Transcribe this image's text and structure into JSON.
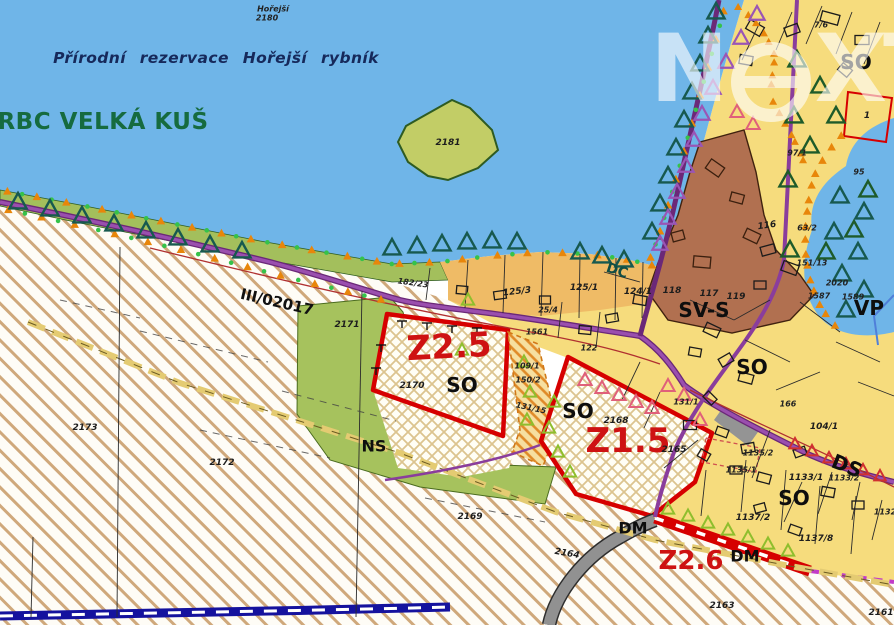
{
  "watermark": {
    "n": "N",
    "e": "e",
    "x": "X",
    "t": "T"
  },
  "colors": {
    "water": "#6FB5E8",
    "parcel_yellow": "#F6DC7D",
    "orange_band": "#EFBB66",
    "brown_zone": "#B17050",
    "green_area": "#A6C25D",
    "island_green": "#C2CD66",
    "zone_red": "#D60000",
    "road_purple": "#8A3D9C",
    "trail_khaki": "#E4CB72",
    "stream_blue": "#15129E",
    "magenta_dash": "#C23CC8",
    "gray_road": "#919191",
    "title_navy": "#16295B",
    "rbc_green": "#166B3F"
  },
  "map": {
    "labels": [
      {
        "id": "horejsi-name",
        "t": "Hořejší",
        "x": 273,
        "y": 9,
        "cls": "t-tiny"
      },
      {
        "id": "horejsi-parcel",
        "t": "2180",
        "x": 267,
        "y": 18,
        "cls": "t-tiny"
      },
      {
        "id": "reserve-title",
        "t": "Přírodní rezervace  Hořejší rybník",
        "x": 216,
        "y": 58,
        "cls": "t-title"
      },
      {
        "id": "rbc-title",
        "t": "RBC VELKÁ KUŠ",
        "x": 103,
        "y": 122,
        "cls": "t-rbc"
      },
      {
        "id": "road-number",
        "t": "III/02017",
        "x": 277,
        "y": 302,
        "rot": 13,
        "cls": "t-road"
      },
      {
        "id": "zone-z25",
        "t": "Z2.5",
        "x": 449,
        "y": 347,
        "rot": -3,
        "cls": "t-zone-xl"
      },
      {
        "id": "z25-use",
        "t": "SO",
        "x": 462,
        "y": 385,
        "cls": "t-use"
      },
      {
        "id": "parcel-2170",
        "t": "2170",
        "x": 412,
        "y": 386,
        "cls": "t-parcel"
      },
      {
        "id": "zone-z15",
        "t": "Z1.5",
        "x": 628,
        "y": 441,
        "cls": "t-zone-xl"
      },
      {
        "id": "z15-use",
        "t": "SO",
        "x": 578,
        "y": 411,
        "cls": "t-use"
      },
      {
        "id": "parcel-2168",
        "t": "2168",
        "x": 616,
        "y": 421,
        "cls": "t-parcel"
      },
      {
        "id": "ns-use",
        "t": "NS",
        "x": 374,
        "y": 446,
        "cls": "t-use-md"
      },
      {
        "id": "zone-z26",
        "t": "Z2.6",
        "x": 691,
        "y": 561,
        "cls": "t-zone-lg"
      },
      {
        "id": "dm-1",
        "t": "DM",
        "x": 633,
        "y": 528,
        "cls": "t-use-md"
      },
      {
        "id": "dm-2",
        "t": "DM",
        "x": 745,
        "y": 556,
        "cls": "t-use-md"
      },
      {
        "id": "ds-use",
        "t": "DS",
        "x": 847,
        "y": 466,
        "rot": 22,
        "cls": "t-use"
      },
      {
        "id": "so-village",
        "t": "SO",
        "x": 752,
        "y": 367,
        "cls": "t-use"
      },
      {
        "id": "so-south",
        "t": "SO",
        "x": 794,
        "y": 498,
        "cls": "t-use"
      },
      {
        "id": "so-northeast",
        "t": "SO",
        "x": 856,
        "y": 62,
        "cls": "t-use"
      },
      {
        "id": "svs-use",
        "t": "SV-S",
        "x": 704,
        "y": 310,
        "cls": "t-use"
      },
      {
        "id": "vp-use",
        "t": "VP",
        "x": 869,
        "y": 308,
        "cls": "t-use"
      },
      {
        "id": "dc-use",
        "t": "DC",
        "x": 617,
        "y": 271,
        "rot": 18,
        "cls": "t-dc"
      },
      {
        "id": "parcel-2181",
        "t": "2181",
        "x": 448,
        "y": 143,
        "cls": "t-parcel"
      },
      {
        "id": "parcel-2171",
        "t": "2171",
        "x": 347,
        "y": 325,
        "cls": "t-parcel"
      },
      {
        "id": "parcel-2173",
        "t": "2173",
        "x": 85,
        "y": 428,
        "cls": "t-parcel"
      },
      {
        "id": "parcel-2172",
        "t": "2172",
        "x": 222,
        "y": 463,
        "cls": "t-parcel"
      },
      {
        "id": "parcel-2169",
        "t": "2169",
        "x": 470,
        "y": 517,
        "cls": "t-parcel"
      },
      {
        "id": "parcel-2164",
        "t": "2164",
        "x": 567,
        "y": 554,
        "rot": 10,
        "cls": "t-parcel"
      },
      {
        "id": "parcel-2163",
        "t": "2163",
        "x": 722,
        "y": 606,
        "cls": "t-parcel"
      },
      {
        "id": "parcel-2161",
        "t": "2161",
        "x": 881,
        "y": 613,
        "cls": "t-parcel"
      },
      {
        "id": "parcel-2165",
        "t": "2165",
        "x": 674,
        "y": 450,
        "cls": "t-parcel"
      },
      {
        "id": "parcel-131-15",
        "t": "131/15",
        "x": 531,
        "y": 408,
        "rot": 12,
        "cls": "t-parcel-sm"
      },
      {
        "id": "parcel-125-3",
        "t": "125/3",
        "x": 517,
        "y": 292,
        "rot": -6,
        "cls": "t-parcel"
      },
      {
        "id": "parcel-125-1",
        "t": "125/1",
        "x": 584,
        "y": 288,
        "cls": "t-parcel"
      },
      {
        "id": "parcel-124-1",
        "t": "124/1",
        "x": 638,
        "y": 292,
        "cls": "t-parcel"
      },
      {
        "id": "parcel-25-4",
        "t": "25/4",
        "x": 548,
        "y": 310,
        "cls": "t-parcel-sm"
      },
      {
        "id": "parcel-1561",
        "t": "1561",
        "x": 537,
        "y": 332,
        "cls": "t-parcel-sm"
      },
      {
        "id": "parcel-122",
        "t": "122",
        "x": 589,
        "y": 348,
        "cls": "t-parcel-sm"
      },
      {
        "id": "parcel-109-1",
        "t": "109/1",
        "x": 527,
        "y": 366,
        "cls": "t-parcel-sm"
      },
      {
        "id": "parcel-150-2",
        "t": "150/2",
        "x": 528,
        "y": 380,
        "cls": "t-parcel-sm"
      },
      {
        "id": "parcel-182-23",
        "t": "182/23",
        "x": 413,
        "y": 283,
        "rot": 8,
        "cls": "t-parcel-sm"
      },
      {
        "id": "parcel-116",
        "t": "116",
        "x": 767,
        "y": 226,
        "rot": -8,
        "cls": "t-parcel"
      },
      {
        "id": "parcel-63-2",
        "t": "63/2",
        "x": 807,
        "y": 228,
        "cls": "t-parcel-sm"
      },
      {
        "id": "parcel-118",
        "t": "118",
        "x": 672,
        "y": 291,
        "cls": "t-parcel"
      },
      {
        "id": "parcel-117",
        "t": "117",
        "x": 709,
        "y": 294,
        "cls": "t-parcel"
      },
      {
        "id": "parcel-119",
        "t": "119",
        "x": 736,
        "y": 297,
        "cls": "t-parcel"
      },
      {
        "id": "parcel-95",
        "t": "95",
        "x": 859,
        "y": 172,
        "cls": "t-parcel-sm"
      },
      {
        "id": "parcel-7-6",
        "t": "7/6",
        "x": 821,
        "y": 25,
        "cls": "t-parcel-sm"
      },
      {
        "id": "parcel-1",
        "t": "1",
        "x": 867,
        "y": 116,
        "cls": "t-parcel"
      },
      {
        "id": "parcel-97-1",
        "t": "97/1",
        "x": 797,
        "y": 153,
        "cls": "t-parcel-sm"
      },
      {
        "id": "parcel-104-1",
        "t": "104/1",
        "x": 824,
        "y": 427,
        "cls": "t-parcel"
      },
      {
        "id": "parcel-131-1",
        "t": "131/1",
        "x": 686,
        "y": 402,
        "cls": "t-parcel-sm"
      },
      {
        "id": "parcel-1133-1",
        "t": "1133/1",
        "x": 806,
        "y": 478,
        "cls": "t-parcel"
      },
      {
        "id": "parcel-1133-2",
        "t": "1133/2",
        "x": 844,
        "y": 478,
        "cls": "t-parcel-sm"
      },
      {
        "id": "parcel-1135-1",
        "t": "1135/1",
        "x": 741,
        "y": 470,
        "cls": "t-parcel-sm"
      },
      {
        "id": "parcel-1135-2",
        "t": "1135/2",
        "x": 758,
        "y": 453,
        "cls": "t-parcel-sm"
      },
      {
        "id": "parcel-1137-2",
        "t": "1137/2",
        "x": 753,
        "y": 518,
        "cls": "t-parcel"
      },
      {
        "id": "parcel-1137-8",
        "t": "1137/8",
        "x": 816,
        "y": 539,
        "cls": "t-parcel"
      },
      {
        "id": "parcel-2020",
        "t": "2020",
        "x": 837,
        "y": 283,
        "cls": "t-parcel-sm"
      },
      {
        "id": "parcel-1589",
        "t": "1589",
        "x": 853,
        "y": 297,
        "cls": "t-parcel-sm"
      },
      {
        "id": "parcel-1587",
        "t": "1587",
        "x": 819,
        "y": 296,
        "cls": "t-parcel-sm"
      },
      {
        "id": "parcel-151-13",
        "t": "151/13",
        "x": 812,
        "y": 263,
        "cls": "t-parcel-sm"
      },
      {
        "id": "parcel-1132",
        "t": "1132",
        "x": 885,
        "y": 512,
        "cls": "t-parcel-sm"
      },
      {
        "id": "parcel-166",
        "t": "166",
        "x": 788,
        "y": 404,
        "cls": "t-parcel-sm"
      }
    ]
  }
}
